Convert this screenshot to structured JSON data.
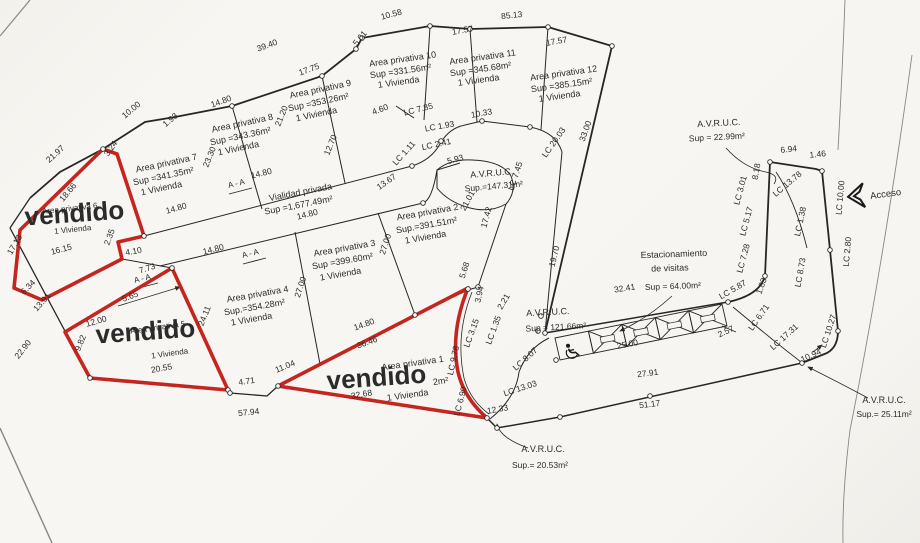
{
  "document": {
    "type": "Lot subdivision site plan (plano de lotificacion) with sold lots marked"
  },
  "palette": {
    "paper": "#f7f5f1",
    "ink": "#2b2b2b",
    "sold_red": "#c4261f"
  },
  "sold_label": "vendido",
  "access": {
    "label": "Acceso"
  },
  "summary": {
    "lots": [
      {
        "name": "Area privativa 1",
        "sup": "",
        "viviendas": "1 Vivienda",
        "status": "vendido"
      },
      {
        "name": "Area privativa 2",
        "sup": "Sup.=391.51m²",
        "viviendas": "1 Vivienda",
        "status": ""
      },
      {
        "name": "Area privativa 3",
        "sup": "Sup =399.60m²",
        "viviendas": "1 Vivienda",
        "status": ""
      },
      {
        "name": "Area privativa 4",
        "sup": "Sup.=354.28m²",
        "viviendas": "1 Vivienda",
        "status": ""
      },
      {
        "name": "Area privativa 5",
        "sup": "",
        "viviendas": "1 Vivienda",
        "status": "vendido"
      },
      {
        "name": "Area privativa 6",
        "sup": "",
        "viviendas": "1 Vivienda",
        "status": "vendido"
      },
      {
        "name": "Area privativa 7",
        "sup": "Sup =341.35m²",
        "viviendas": "1 Vivienda",
        "status": ""
      },
      {
        "name": "Area privativa 8",
        "sup": "Sup =343.36m²",
        "viviendas": "1 Vivienda",
        "status": ""
      },
      {
        "name": "Area privativa 9",
        "sup": "Sup =353.26m²",
        "viviendas": "1 Vivienda",
        "status": ""
      },
      {
        "name": "Area privativa 10",
        "sup": "Sup =331.56m²",
        "viviendas": "1 Vivienda",
        "status": ""
      },
      {
        "name": "Area privativa 11",
        "sup": "Sup =345.68m²",
        "viviendas": "1 Vivienda",
        "status": ""
      },
      {
        "name": "Area privativa 12",
        "sup": "Sup =385.15m²",
        "viviendas": "1 Vivienda",
        "status": ""
      }
    ],
    "common_areas": [
      {
        "name": "Vialidad privada",
        "sup": "Sup =1,677.49m²"
      },
      {
        "name": "A.V.R.U.C.",
        "sup": "Sup.=147.31m²"
      },
      {
        "name": "A.V.R.U.C.",
        "sup": "Sup = 121.66m²"
      },
      {
        "name": "A.V.R.U.C.",
        "sup": "Sup = 22.99m²"
      },
      {
        "name": "A.V.R.U.C.",
        "sup": "Sup.= 25.11m²"
      },
      {
        "name": "A.V.R.U.C.",
        "sup": "Sup.= 20.53m²"
      },
      {
        "name": "Estacionamiento de visitas",
        "sup": "Sup = 64.00m²"
      }
    ]
  },
  "parking": {
    "stall_count": 5,
    "accessible_stalls": 1,
    "length_label": "25.00"
  },
  "labels": [
    [
      "Area privativa 7",
      167,
      166,
      -12,
      9,
      null,
      null,
      "lot-label"
    ],
    [
      "Sup =341.35m²",
      164,
      179,
      -12,
      9,
      null,
      null,
      "lot-sup"
    ],
    [
      "1 Vivienda",
      162,
      191,
      -12,
      9,
      null,
      null,
      "lot-viviendas"
    ],
    [
      "Area privativa 8",
      243,
      126,
      -12,
      9,
      null,
      null,
      "lot-label"
    ],
    [
      "Sup =343.36m²",
      241,
      139,
      -12,
      9,
      null,
      null,
      "lot-sup"
    ],
    [
      "1 Vivienda",
      239,
      151,
      -12,
      9,
      null,
      null,
      "lot-viviendas"
    ],
    [
      "Area privativa 9",
      321,
      92,
      -12,
      9,
      null,
      null,
      "lot-label"
    ],
    [
      "Sup =353.26m²",
      319,
      105,
      -12,
      9,
      null,
      null,
      "lot-sup"
    ],
    [
      "1 Vivienda",
      317,
      117,
      -12,
      9,
      null,
      null,
      "lot-viviendas"
    ],
    [
      "Area privativa 10",
      403,
      62,
      -8,
      9,
      null,
      null,
      "lot-label"
    ],
    [
      "Sup =331.56m²",
      401,
      74,
      -8,
      9,
      null,
      null,
      "lot-sup"
    ],
    [
      "1 Vivienda",
      399,
      85,
      -8,
      9,
      null,
      null,
      "lot-viviendas"
    ],
    [
      "Area privativa 11",
      483,
      60,
      -8,
      9,
      null,
      null,
      "lot-label"
    ],
    [
      "Sup =345.68m²",
      481,
      72,
      -8,
      9,
      null,
      null,
      "lot-sup"
    ],
    [
      "1 Vivienda",
      479,
      83,
      -8,
      9,
      null,
      null,
      "lot-viviendas"
    ],
    [
      "Area privativa 12",
      564,
      76,
      -8,
      9,
      null,
      null,
      "lot-label"
    ],
    [
      "Sup =385.15m²",
      562,
      88,
      -8,
      9,
      null,
      null,
      "lot-sup"
    ],
    [
      "1 Vivienda",
      560,
      99,
      -8,
      9,
      null,
      null,
      "lot-viviendas"
    ],
    [
      "Area privativa 2",
      428,
      215,
      -10,
      9,
      null,
      null,
      "lot-label"
    ],
    [
      "Sup.=391.51m²",
      427,
      228,
      -10,
      9,
      null,
      null,
      "lot-sup"
    ],
    [
      "1 Vivienda",
      426,
      240,
      -10,
      9,
      null,
      null,
      "lot-viviendas"
    ],
    [
      "Area privativa 3",
      345,
      251,
      -10,
      9,
      null,
      null,
      "lot-label"
    ],
    [
      "Sup =399.60m²",
      343,
      264,
      -10,
      9,
      null,
      null,
      "lot-sup"
    ],
    [
      "1 Vivienda",
      341,
      277,
      -10,
      9,
      null,
      null,
      "lot-viviendas"
    ],
    [
      "Area privativa 4",
      258,
      297,
      -10,
      9,
      null,
      null,
      "lot-label"
    ],
    [
      "Sup.=354.28m²",
      255,
      310,
      -10,
      9,
      null,
      null,
      "lot-sup"
    ],
    [
      "1 Vivienda",
      252,
      322,
      -10,
      9,
      null,
      null,
      "lot-viviendas"
    ],
    [
      "Area privativa 5",
      158,
      330,
      -8,
      8,
      null,
      null,
      "lot-label"
    ],
    [
      "1 Vivienda",
      170,
      356,
      -8,
      8,
      null,
      null,
      "lot-viviendas"
    ],
    [
      "Area privativa 6",
      70,
      211,
      -6,
      8,
      null,
      null,
      "lot-label"
    ],
    [
      "1 Vivienda",
      73,
      232,
      -6,
      8,
      null,
      null,
      "lot-viviendas"
    ],
    [
      "Area privativa 1",
      413,
      366,
      -8,
      9,
      null,
      null,
      "lot-label"
    ],
    [
      "2m²",
      441,
      384,
      -8,
      9,
      null,
      null,
      "lot-sup"
    ],
    [
      "1 Vivienda",
      408,
      398,
      -8,
      9,
      null,
      null,
      "lot-viviendas"
    ],
    [
      "vendido",
      75,
      222,
      -4,
      26,
      "red",
      "bold",
      "vendido-label"
    ],
    [
      "vendido",
      146,
      340,
      -4,
      26,
      "red",
      "bold",
      "vendido-label"
    ],
    [
      "vendido",
      377,
      386,
      -4,
      26,
      "red",
      "bold",
      "vendido-label"
    ],
    [
      "Vialidad privada",
      301,
      195,
      -11,
      9,
      null,
      null,
      "road-label"
    ],
    [
      "Sup =1,677.49m²",
      299,
      208,
      -11,
      9,
      null,
      null,
      "road-sup"
    ],
    [
      "A.V.R.U.C.",
      492,
      176,
      -5,
      9,
      null,
      null,
      "avruc-label"
    ],
    [
      "Sup.=147.31m²",
      494,
      189,
      -5,
      8.5,
      null,
      null,
      "avruc-sup"
    ],
    [
      "A.V.R.U.C.",
      548,
      315,
      -3,
      9,
      null,
      null,
      "avruc-label"
    ],
    [
      "Sup = 121.66m²",
      556,
      330,
      -3,
      8.5,
      null,
      null,
      "avruc-sup"
    ],
    [
      "A.V.R.U.C.",
      719,
      126,
      -3,
      9,
      null,
      null,
      "avruc-label"
    ],
    [
      "Sup = 22.99m²",
      717,
      140,
      -3,
      8.5,
      null,
      null,
      "avruc-sup"
    ],
    [
      "A.V.R.U.C.",
      884,
      403,
      0,
      9,
      null,
      null,
      "avruc-label"
    ],
    [
      "Sup.= 25.11m²",
      884,
      417,
      0,
      8.5,
      null,
      null,
      "avruc-sup"
    ],
    [
      "A.V.R.U.C.",
      543,
      452,
      0,
      9,
      null,
      null,
      "avruc-label"
    ],
    [
      "Sup.= 20.53m²",
      540,
      468,
      0,
      8.5,
      null,
      null,
      "avruc-sup"
    ],
    [
      "Estacionamiento",
      674,
      257,
      -2,
      9,
      null,
      null,
      "parking-label"
    ],
    [
      "de visitas",
      670,
      271,
      -2,
      9,
      null,
      null,
      "parking-label"
    ],
    [
      "Sup = 64.00m²",
      673,
      289,
      -2,
      8.5,
      null,
      null,
      "parking-sup"
    ],
    [
      "Acceso",
      886,
      197,
      -8,
      9.5,
      null,
      null,
      "acceso-label"
    ],
    [
      "A - A",
      237,
      186,
      -14,
      8,
      null,
      null,
      "section-label"
    ],
    [
      "A - A",
      251,
      256,
      -14,
      8,
      null,
      null,
      "section-label"
    ],
    [
      "A - A",
      143,
      281,
      -14,
      8,
      null,
      null,
      "section-label"
    ],
    [
      "39.40",
      268,
      48,
      -20
    ],
    [
      "17.75",
      310,
      72,
      -20
    ],
    [
      "10.58",
      392,
      17,
      -15
    ],
    [
      "5.01",
      362,
      40,
      -50
    ],
    [
      "85.13",
      512,
      18,
      -6
    ],
    [
      "17.57",
      463,
      33,
      -10
    ],
    [
      "17.57",
      557,
      44,
      -10
    ],
    [
      "10.33",
      482,
      116,
      -10
    ],
    [
      "4.60",
      381,
      112,
      -20
    ],
    [
      "12.70",
      333,
      146,
      -68
    ],
    [
      "21.20",
      284,
      117,
      -68
    ],
    [
      "23.30",
      212,
      158,
      -68
    ],
    [
      "1.93",
      172,
      122,
      -40
    ],
    [
      "10.00",
      133,
      112,
      -40
    ],
    [
      "21.97",
      57,
      156,
      -42
    ],
    [
      "3.24",
      113,
      150,
      -55
    ],
    [
      "18.66",
      70,
      194,
      -50
    ],
    [
      "16.15",
      62,
      252,
      -15
    ],
    [
      "17.13",
      17,
      246,
      -60
    ],
    [
      "4.10",
      134,
      254,
      -10
    ],
    [
      "2.35",
      112,
      238,
      -70
    ],
    [
      "7.73",
      148,
      271,
      -18
    ],
    [
      "5.65",
      131,
      299,
      -20
    ],
    [
      "12.00",
      97,
      324,
      -16
    ],
    [
      "9.82",
      83,
      344,
      -68
    ],
    [
      "6.34",
      30,
      289,
      -45
    ],
    [
      "13.91",
      44,
      304,
      -48
    ],
    [
      "22.90",
      25,
      351,
      -52
    ],
    [
      "20.55",
      162,
      371,
      -10
    ],
    [
      "24.11",
      207,
      317,
      -68
    ],
    [
      "4.71",
      247,
      384,
      -8
    ],
    [
      "57.94",
      249,
      415,
      -6
    ],
    [
      "11.04",
      286,
      369,
      -22
    ],
    [
      "14.80",
      222,
      104,
      -20
    ],
    [
      "14.80",
      177,
      211,
      -16
    ],
    [
      "14.80",
      262,
      176,
      -14
    ],
    [
      "14.80",
      308,
      217,
      -14
    ],
    [
      "14.80",
      214,
      252,
      -14
    ],
    [
      "14.80",
      365,
      327,
      -20
    ],
    [
      "36.46",
      368,
      345,
      -20
    ],
    [
      "32.68",
      362,
      397,
      -10
    ],
    [
      "27.00",
      388,
      245,
      -72
    ],
    [
      "27.00",
      303,
      288,
      -72
    ],
    [
      "13.67",
      388,
      184,
      -35
    ],
    [
      "5.93",
      456,
      162,
      -15
    ],
    [
      "21.01",
      470,
      202,
      -62
    ],
    [
      "17.42",
      489,
      218,
      -75
    ],
    [
      "5.68",
      467,
      271,
      -72
    ],
    [
      "3.94",
      482,
      295,
      -78
    ],
    [
      "2.21",
      506,
      303,
      -60
    ],
    [
      "19.70",
      557,
      257,
      -76
    ],
    [
      "33.00",
      588,
      132,
      -70
    ],
    [
      "12.33",
      498,
      412,
      -10
    ],
    [
      "51.17",
      650,
      407,
      -7
    ],
    [
      "27.91",
      648,
      376,
      -7
    ],
    [
      "25.00",
      628,
      347,
      -11
    ],
    [
      "32.41",
      625,
      291,
      -9
    ],
    [
      "2.57",
      727,
      334,
      -25
    ],
    [
      "1.83",
      764,
      287,
      -70
    ],
    [
      "10.94",
      812,
      358,
      -25
    ],
    [
      "6.94",
      789,
      152,
      -6
    ],
    [
      "1.46",
      818,
      157,
      -6
    ],
    [
      "8.18",
      759,
      172,
      -80
    ],
    [
      "LC 7.85",
      419,
      112,
      -14,
      8.5,
      null,
      null,
      "curve-length-label"
    ],
    [
      "LC 1.93",
      440,
      129,
      -10,
      8.5,
      null,
      null,
      "curve-length-label"
    ],
    [
      "LC 2.41",
      437,
      147,
      -12,
      8.5,
      null,
      null,
      "curve-length-label"
    ],
    [
      "LC 1.11",
      406,
      155,
      -48,
      8.5,
      null,
      null,
      "curve-length-label"
    ],
    [
      "LC 20.03",
      556,
      144,
      -55,
      8.5,
      null,
      null,
      "curve-length-label"
    ],
    [
      "LC 7.45",
      518,
      177,
      -72,
      8.5,
      null,
      null,
      "curve-length-label"
    ],
    [
      "LC 9.78",
      456,
      361,
      -78,
      8.5,
      null,
      null,
      "curve-length-label"
    ],
    [
      "LC 3.15",
      474,
      334,
      -70,
      8.5,
      null,
      null,
      "curve-length-label"
    ],
    [
      "LC 1.35",
      496,
      331,
      -70,
      8.5,
      null,
      null,
      "curve-length-label"
    ],
    [
      "LC 8.07",
      527,
      361,
      -42,
      8.5,
      null,
      null,
      "curve-length-label"
    ],
    [
      "LC 13.03",
      521,
      391,
      -18,
      8.5,
      null,
      null,
      "curve-length-label"
    ],
    [
      "LC 6.90",
      463,
      402,
      -75,
      8.5,
      null,
      null,
      "curve-length-label"
    ],
    [
      "LC 6.71",
      761,
      319,
      -55,
      8.5,
      null,
      null,
      "curve-length-label"
    ],
    [
      "LC 5.87",
      734,
      292,
      -30,
      8.5,
      null,
      null,
      "curve-length-label"
    ],
    [
      "LC 7.28",
      746,
      259,
      -75,
      8.5,
      null,
      null,
      "curve-length-label"
    ],
    [
      "LC 5.17",
      749,
      222,
      -75,
      8.5,
      null,
      null,
      "curve-length-label"
    ],
    [
      "LC 3.01",
      743,
      191,
      -75,
      8.5,
      null,
      null,
      "curve-length-label"
    ],
    [
      "LC 13.78",
      789,
      186,
      -40,
      8.5,
      null,
      null,
      "curve-length-label"
    ],
    [
      "LC 1.38",
      803,
      222,
      -78,
      8.5,
      null,
      null,
      "curve-length-label"
    ],
    [
      "LC 8.73",
      803,
      273,
      -80,
      8.5,
      null,
      null,
      "curve-length-label"
    ],
    [
      "LC 17.31",
      786,
      339,
      -42,
      8.5,
      null,
      null,
      "curve-length-label"
    ],
    [
      "LC 10.27",
      831,
      332,
      -72,
      8.5,
      null,
      null,
      "curve-length-label"
    ],
    [
      "LC 10.00",
      843,
      198,
      -85,
      8.5,
      null,
      null,
      "curve-length-label"
    ],
    [
      "LC 2.80",
      850,
      252,
      -85,
      8.5,
      null,
      null,
      "curve-length-label"
    ]
  ]
}
